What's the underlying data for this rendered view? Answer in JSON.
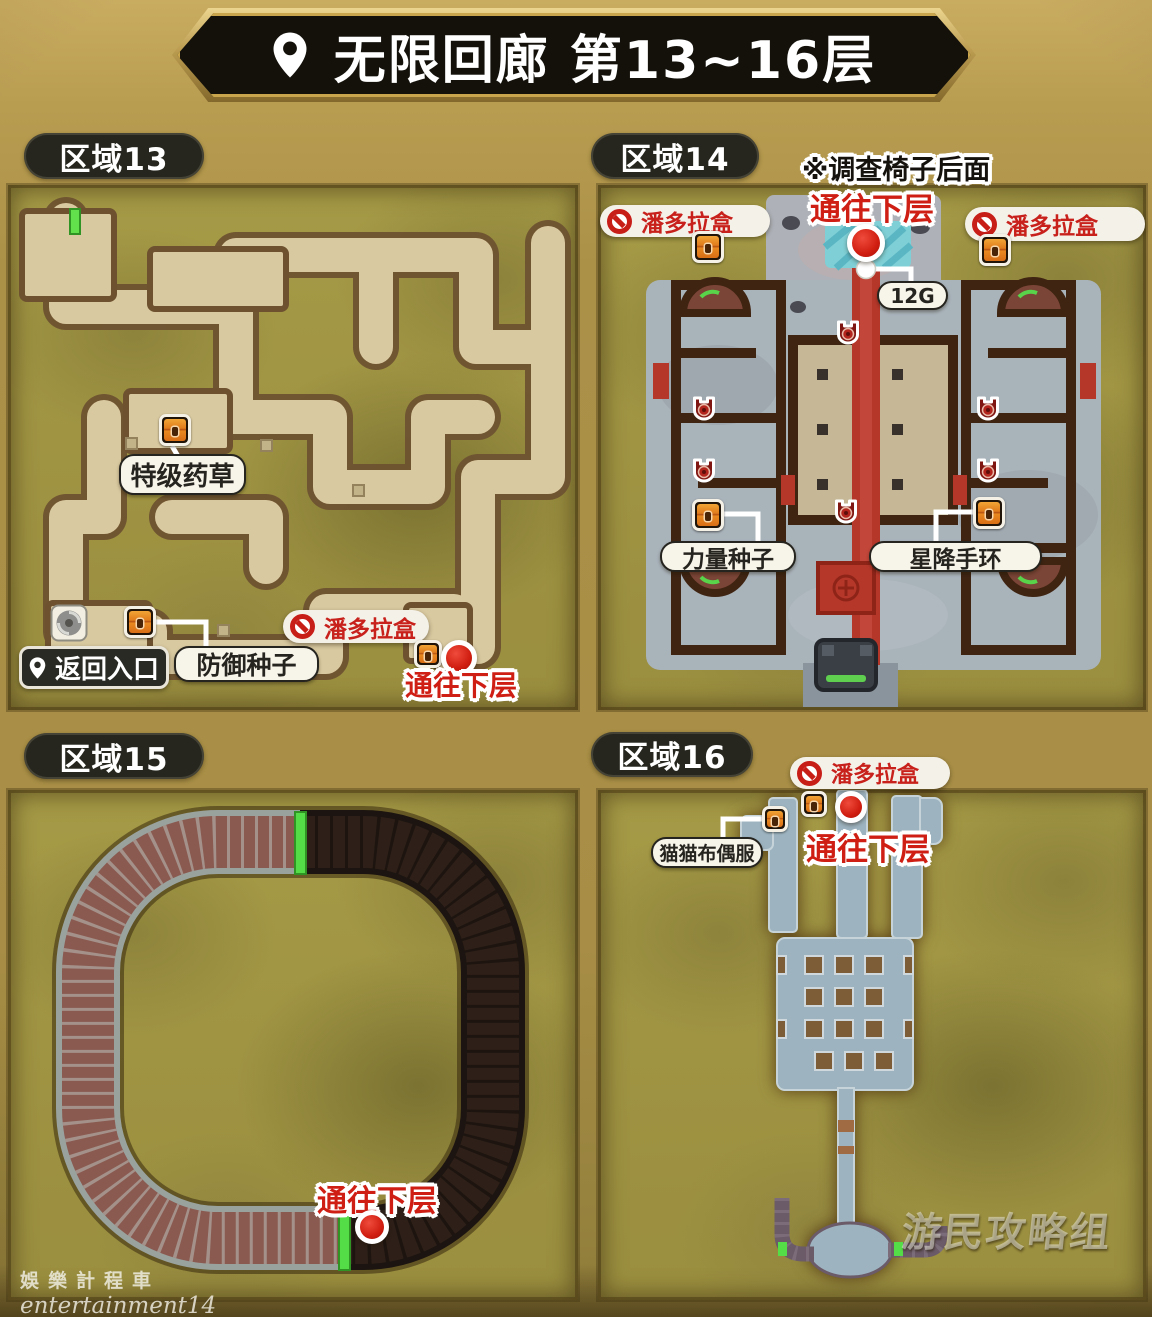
{
  "header": {
    "title": "无限回廊 第13~16层"
  },
  "area13": {
    "label": "区域13",
    "herb_label": "特级药草",
    "seed_label": "防御种子",
    "entrance_label": "返回入口",
    "pandora_label": "潘多拉盒",
    "stairs_label": "通往下层"
  },
  "area14": {
    "label": "区域14",
    "note": "※调查椅子后面",
    "stairs_label": "通往下层",
    "pandora_left": "潘多拉盒",
    "pandora_right": "潘多拉盒",
    "gold_label": "12G",
    "power_seed_label": "力量种子",
    "bracelet_label": "星降手环"
  },
  "area15": {
    "label": "区域15",
    "stairs_label": "通往下层"
  },
  "area16": {
    "label": "区域16",
    "pandora_label": "潘多拉盒",
    "costume_label": "猫猫布偶服",
    "stairs_label": "通往下层"
  },
  "watermarks": {
    "taxi_cn": "娛樂計程車",
    "taxi_en": "entertainment14",
    "gamersky": "游民攻略组"
  },
  "colors": {
    "accent_red": "#cf1f14",
    "gold_bg": "#ab9148",
    "panel_olive": "#a09441"
  }
}
